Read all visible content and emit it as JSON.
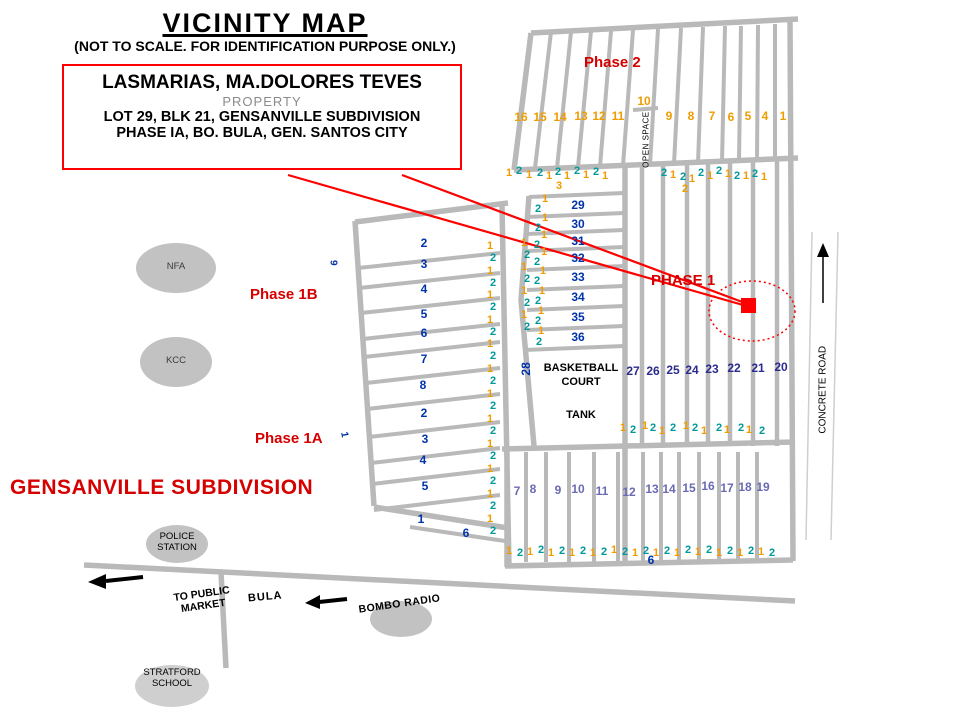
{
  "title": "VICINITY MAP",
  "subtitle": "(NOT TO SCALE. FOR IDENTIFICATION PURPOSE ONLY.)",
  "callout": {
    "owner": "LASMARIAS, MA.DOLORES TEVES",
    "kind": "PROPERTY",
    "lot": "LOT 29, BLK 21, GENSANVILLE SUBDIVISION",
    "location": "PHASE IA, BO. BULA,  GEN. SANTOS CITY"
  },
  "colors": {
    "red": "#D60000",
    "graphic_red": "#FF0000",
    "road": "#B9B9B9",
    "o": "#EE9C00",
    "t": "#009999",
    "b": "#0033AA",
    "n": "#2B2B8E",
    "s": "#6A6AB4",
    "k": "#000000",
    "g": "#3C3C3C"
  },
  "map_labels": [
    {
      "id": "phase-2-label",
      "t": "Phase 2",
      "x": 584,
      "y": 54,
      "s": 15,
      "c": "red",
      "b": 1
    },
    {
      "id": "phase-1-label",
      "t": "PHASE 1",
      "x": 651,
      "y": 272,
      "s": 15,
      "c": "red",
      "b": 1
    },
    {
      "id": "phase-1b-label",
      "t": "Phase 1B",
      "x": 250,
      "y": 286,
      "s": 15,
      "c": "red",
      "b": 1
    },
    {
      "id": "phase-1a-label",
      "t": "Phase 1A",
      "x": 255,
      "y": 430,
      "s": 15,
      "c": "red",
      "b": 1
    },
    {
      "id": "subdivision-name",
      "t": "GENSANVILLE SUBDIVISION",
      "x": 10,
      "y": 476,
      "s": 21,
      "c": "red",
      "b": 1,
      "ls": 0.5
    },
    {
      "id": "nfa-label",
      "t": "NFA",
      "x": 160,
      "y": 262,
      "s": 9.5,
      "c": "g",
      "w": 32,
      "ta": "center"
    },
    {
      "id": "kcc-label",
      "t": "KCC",
      "x": 160,
      "y": 356,
      "s": 9.5,
      "c": "g",
      "w": 32,
      "ta": "center"
    },
    {
      "id": "police-station-label",
      "t": "POLICE\nSTATION",
      "x": 147,
      "y": 532,
      "s": 9.5,
      "c": "k",
      "w": 60,
      "ta": "center",
      "pre": 1
    },
    {
      "id": "stratford-school-label",
      "t": "STRATFORD\nSCHOOL",
      "x": 132,
      "y": 668,
      "s": 9.5,
      "c": "k",
      "w": 80,
      "ta": "center",
      "pre": 1
    },
    {
      "id": "basketball-court-label",
      "t": "BASKETBALL\nCOURT",
      "x": 536,
      "y": 361,
      "s": 11,
      "c": "k",
      "b": 1,
      "w": 90,
      "ta": "center",
      "pre": 1,
      "lh": 1.3
    },
    {
      "id": "tank-label",
      "t": "TANK",
      "x": 536,
      "y": 409,
      "s": 11,
      "c": "k",
      "b": 1,
      "w": 90,
      "ta": "center"
    },
    {
      "id": "open-space-label",
      "t": "OPEN SPACE",
      "x": 606,
      "y": 135,
      "s": 8,
      "c": "k",
      "w": 80,
      "ta": "center",
      "r": -90,
      "ls": 0.5
    },
    {
      "id": "concrete-road-label",
      "t": "CONCRETE ROAD",
      "x": 767,
      "y": 384,
      "s": 10,
      "c": "k",
      "w": 112,
      "ta": "center",
      "r": -90
    },
    {
      "id": "to-public-market-label",
      "t": "TO PUBLIC\nMARKET",
      "x": 150,
      "y": 588,
      "s": 10.5,
      "c": "k",
      "b": 1,
      "w": 105,
      "ta": "center",
      "r": -8,
      "pre": 1
    },
    {
      "id": "bula-label",
      "t": "BULA",
      "x": 248,
      "y": 591,
      "s": 11,
      "c": "k",
      "b": 1,
      "r": -5,
      "ls": 1
    },
    {
      "id": "bombo-radio-label",
      "t": "BOMBO RADIO",
      "x": 352,
      "y": 598,
      "s": 10.5,
      "c": "k",
      "b": 1,
      "w": 95,
      "ta": "center",
      "r": -8,
      "ls": 0.5
    },
    {
      "id": "lot-28-label",
      "t": "28",
      "x": 516,
      "y": 362,
      "s": 12,
      "c": "b",
      "b": 1,
      "w": 22,
      "ta": "center",
      "r": -90
    },
    {
      "id": "rotated-9-label",
      "t": "9",
      "x": 330,
      "y": 257,
      "s": 10,
      "c": "b",
      "b": 1,
      "r": 90
    },
    {
      "id": "rotated-1-label",
      "t": "1",
      "x": 341,
      "y": 429,
      "s": 10,
      "c": "b",
      "b": 1,
      "r": 80
    }
  ],
  "lot_markers": [
    [
      "16",
      521,
      117,
      "o",
      12
    ],
    [
      "15",
      540,
      117,
      "o",
      12
    ],
    [
      "14",
      560,
      117,
      "o",
      12
    ],
    [
      "13",
      581,
      116,
      "o",
      12
    ],
    [
      "12",
      599,
      116,
      "o",
      12
    ],
    [
      "11",
      618,
      116,
      "o",
      12
    ],
    [
      "10",
      644,
      101,
      "o",
      12
    ],
    [
      "9",
      669,
      116,
      "o",
      12
    ],
    [
      "8",
      691,
      116,
      "o",
      12
    ],
    [
      "7",
      712,
      116,
      "o",
      12
    ],
    [
      "6",
      731,
      117,
      "o",
      12
    ],
    [
      "5",
      748,
      116,
      "o",
      12
    ],
    [
      "4",
      765,
      116,
      "o",
      12
    ],
    [
      "1",
      783,
      116,
      "o",
      12
    ],
    [
      "1",
      509,
      173,
      "o"
    ],
    [
      "2",
      519,
      171,
      "t"
    ],
    [
      "1",
      529,
      175,
      "o"
    ],
    [
      "2",
      540,
      173,
      "t"
    ],
    [
      "1",
      549,
      176,
      "o"
    ],
    [
      "2",
      558,
      172,
      "t"
    ],
    [
      "1",
      567,
      176,
      "o"
    ],
    [
      "2",
      577,
      171,
      "t"
    ],
    [
      "1",
      586,
      175,
      "o"
    ],
    [
      "2",
      596,
      172,
      "t"
    ],
    [
      "1",
      605,
      176,
      "o"
    ],
    [
      "3",
      559,
      186,
      "o"
    ],
    [
      "2",
      664,
      173,
      "t"
    ],
    [
      "1",
      673,
      175,
      "o"
    ],
    [
      "2",
      683,
      177,
      "t"
    ],
    [
      "1",
      692,
      179,
      "o"
    ],
    [
      "2",
      701,
      173,
      "t"
    ],
    [
      "1",
      710,
      176,
      "o"
    ],
    [
      "2",
      719,
      171,
      "t"
    ],
    [
      "1",
      728,
      174,
      "o"
    ],
    [
      "2",
      737,
      176,
      "t"
    ],
    [
      "1",
      746,
      176,
      "o"
    ],
    [
      "2",
      755,
      174,
      "t"
    ],
    [
      "1",
      764,
      177,
      "o"
    ],
    [
      "2",
      685,
      189,
      "o"
    ],
    [
      "1",
      490,
      246,
      "o"
    ],
    [
      "2",
      493,
      258,
      "t"
    ],
    [
      "1",
      490,
      271,
      "o"
    ],
    [
      "2",
      493,
      283,
      "t"
    ],
    [
      "1",
      490,
      295,
      "o"
    ],
    [
      "2",
      493,
      307,
      "t"
    ],
    [
      "1",
      490,
      320,
      "o"
    ],
    [
      "2",
      493,
      332,
      "t"
    ],
    [
      "1",
      490,
      344,
      "o"
    ],
    [
      "2",
      493,
      356,
      "t"
    ],
    [
      "1",
      490,
      369,
      "o"
    ],
    [
      "2",
      493,
      381,
      "t"
    ],
    [
      "1",
      490,
      394,
      "o"
    ],
    [
      "2",
      493,
      406,
      "t"
    ],
    [
      "1",
      490,
      419,
      "o"
    ],
    [
      "2",
      493,
      431,
      "t"
    ],
    [
      "1",
      490,
      444,
      "o"
    ],
    [
      "2",
      493,
      456,
      "t"
    ],
    [
      "1",
      490,
      469,
      "o"
    ],
    [
      "2",
      493,
      481,
      "t"
    ],
    [
      "1",
      490,
      494,
      "o"
    ],
    [
      "2",
      493,
      506,
      "t"
    ],
    [
      "1",
      490,
      519,
      "o"
    ],
    [
      "2",
      493,
      531,
      "t"
    ],
    [
      "1",
      524,
      243,
      "o"
    ],
    [
      "2",
      527,
      255,
      "t"
    ],
    [
      "1",
      524,
      267,
      "o"
    ],
    [
      "2",
      527,
      279,
      "t"
    ],
    [
      "1",
      524,
      291,
      "o"
    ],
    [
      "2",
      527,
      303,
      "t"
    ],
    [
      "1",
      524,
      315,
      "o"
    ],
    [
      "2",
      527,
      327,
      "t"
    ],
    [
      "1",
      545,
      199,
      "o"
    ],
    [
      "2",
      538,
      209,
      "t"
    ],
    [
      "1",
      545,
      218,
      "o"
    ],
    [
      "2",
      538,
      228,
      "t"
    ],
    [
      "1",
      544,
      235,
      "o"
    ],
    [
      "2",
      537,
      245,
      "t"
    ],
    [
      "1",
      544,
      252,
      "o"
    ],
    [
      "2",
      537,
      262,
      "t"
    ],
    [
      "1",
      543,
      271,
      "o"
    ],
    [
      "2",
      537,
      281,
      "t"
    ],
    [
      "1",
      542,
      291,
      "o"
    ],
    [
      "2",
      538,
      301,
      "t"
    ],
    [
      "1",
      541,
      311,
      "o"
    ],
    [
      "2",
      538,
      321,
      "t"
    ],
    [
      "1",
      541,
      331,
      "o"
    ],
    [
      "2",
      539,
      342,
      "t"
    ],
    [
      "29",
      578,
      205,
      "b",
      12
    ],
    [
      "30",
      578,
      224,
      "b",
      12
    ],
    [
      "31",
      578,
      241,
      "b",
      12
    ],
    [
      "32",
      578,
      258,
      "b",
      12
    ],
    [
      "33",
      578,
      277,
      "b",
      12
    ],
    [
      "34",
      578,
      297,
      "b",
      12
    ],
    [
      "35",
      578,
      317,
      "b",
      12
    ],
    [
      "36",
      578,
      337,
      "b",
      12
    ],
    [
      "27",
      633,
      371,
      "n",
      12
    ],
    [
      "26",
      653,
      371,
      "n",
      12
    ],
    [
      "25",
      673,
      370,
      "n",
      12
    ],
    [
      "24",
      692,
      370,
      "n",
      12
    ],
    [
      "23",
      712,
      369,
      "n",
      12
    ],
    [
      "22",
      734,
      368,
      "n",
      12
    ],
    [
      "21",
      758,
      368,
      "n",
      12
    ],
    [
      "20",
      781,
      367,
      "n",
      12
    ],
    [
      "1",
      623,
      428,
      "o"
    ],
    [
      "2",
      633,
      430,
      "t"
    ],
    [
      "1",
      645,
      426,
      "o"
    ],
    [
      "2",
      653,
      428,
      "t"
    ],
    [
      "1",
      662,
      431,
      "o"
    ],
    [
      "2",
      673,
      428,
      "t"
    ],
    [
      "1",
      686,
      426,
      "o"
    ],
    [
      "2",
      695,
      428,
      "t"
    ],
    [
      "1",
      704,
      431,
      "o"
    ],
    [
      "2",
      719,
      428,
      "t"
    ],
    [
      "1",
      727,
      430,
      "o"
    ],
    [
      "2",
      741,
      428,
      "t"
    ],
    [
      "1",
      749,
      430,
      "o"
    ],
    [
      "2",
      762,
      431,
      "t"
    ],
    [
      "7",
      517,
      491,
      "s",
      12
    ],
    [
      "8",
      533,
      489,
      "s",
      12
    ],
    [
      "9",
      558,
      490,
      "s",
      12
    ],
    [
      "10",
      578,
      489,
      "s",
      12
    ],
    [
      "11",
      602,
      491,
      "s",
      12
    ],
    [
      "12",
      629,
      492,
      "s",
      12
    ],
    [
      "13",
      652,
      489,
      "s",
      12
    ],
    [
      "14",
      669,
      489,
      "s",
      12
    ],
    [
      "15",
      689,
      488,
      "s",
      12
    ],
    [
      "16",
      708,
      486,
      "s",
      12
    ],
    [
      "17",
      727,
      488,
      "s",
      12
    ],
    [
      "18",
      745,
      487,
      "s",
      12
    ],
    [
      "19",
      763,
      487,
      "s",
      12
    ],
    [
      "1",
      509,
      551,
      "o"
    ],
    [
      "2",
      520,
      553,
      "t"
    ],
    [
      "1",
      530,
      552,
      "o"
    ],
    [
      "2",
      541,
      550,
      "t"
    ],
    [
      "1",
      551,
      553,
      "o"
    ],
    [
      "2",
      562,
      551,
      "t"
    ],
    [
      "1",
      572,
      553,
      "o"
    ],
    [
      "2",
      583,
      551,
      "t"
    ],
    [
      "1",
      593,
      553,
      "o"
    ],
    [
      "2",
      604,
      552,
      "t"
    ],
    [
      "1",
      614,
      550,
      "o"
    ],
    [
      "2",
      625,
      552,
      "t"
    ],
    [
      "1",
      635,
      553,
      "o"
    ],
    [
      "2",
      646,
      551,
      "t"
    ],
    [
      "1",
      656,
      553,
      "o"
    ],
    [
      "2",
      667,
      551,
      "t"
    ],
    [
      "1",
      677,
      553,
      "o"
    ],
    [
      "2",
      688,
      550,
      "t"
    ],
    [
      "1",
      698,
      552,
      "o"
    ],
    [
      "2",
      709,
      550,
      "t"
    ],
    [
      "1",
      719,
      553,
      "o"
    ],
    [
      "2",
      730,
      551,
      "t"
    ],
    [
      "1",
      740,
      553,
      "o"
    ],
    [
      "2",
      751,
      551,
      "t"
    ],
    [
      "1",
      761,
      552,
      "o"
    ],
    [
      "2",
      772,
      553,
      "t"
    ],
    [
      "6",
      651,
      560,
      "b",
      12
    ],
    [
      "2",
      424,
      243,
      "b",
      12
    ],
    [
      "3",
      424,
      264,
      "b",
      12
    ],
    [
      "4",
      424,
      289,
      "b",
      12
    ],
    [
      "5",
      424,
      314,
      "b",
      12
    ],
    [
      "6",
      424,
      333,
      "b",
      12
    ],
    [
      "7",
      424,
      359,
      "b",
      12
    ],
    [
      "8",
      423,
      385,
      "b",
      12
    ],
    [
      "2",
      424,
      413,
      "b",
      12
    ],
    [
      "3",
      425,
      439,
      "b",
      12
    ],
    [
      "4",
      423,
      460,
      "b",
      12
    ],
    [
      "5",
      425,
      486,
      "b",
      12
    ],
    [
      "1",
      421,
      519,
      "b",
      12
    ],
    [
      "6",
      466,
      533,
      "b",
      12
    ]
  ]
}
